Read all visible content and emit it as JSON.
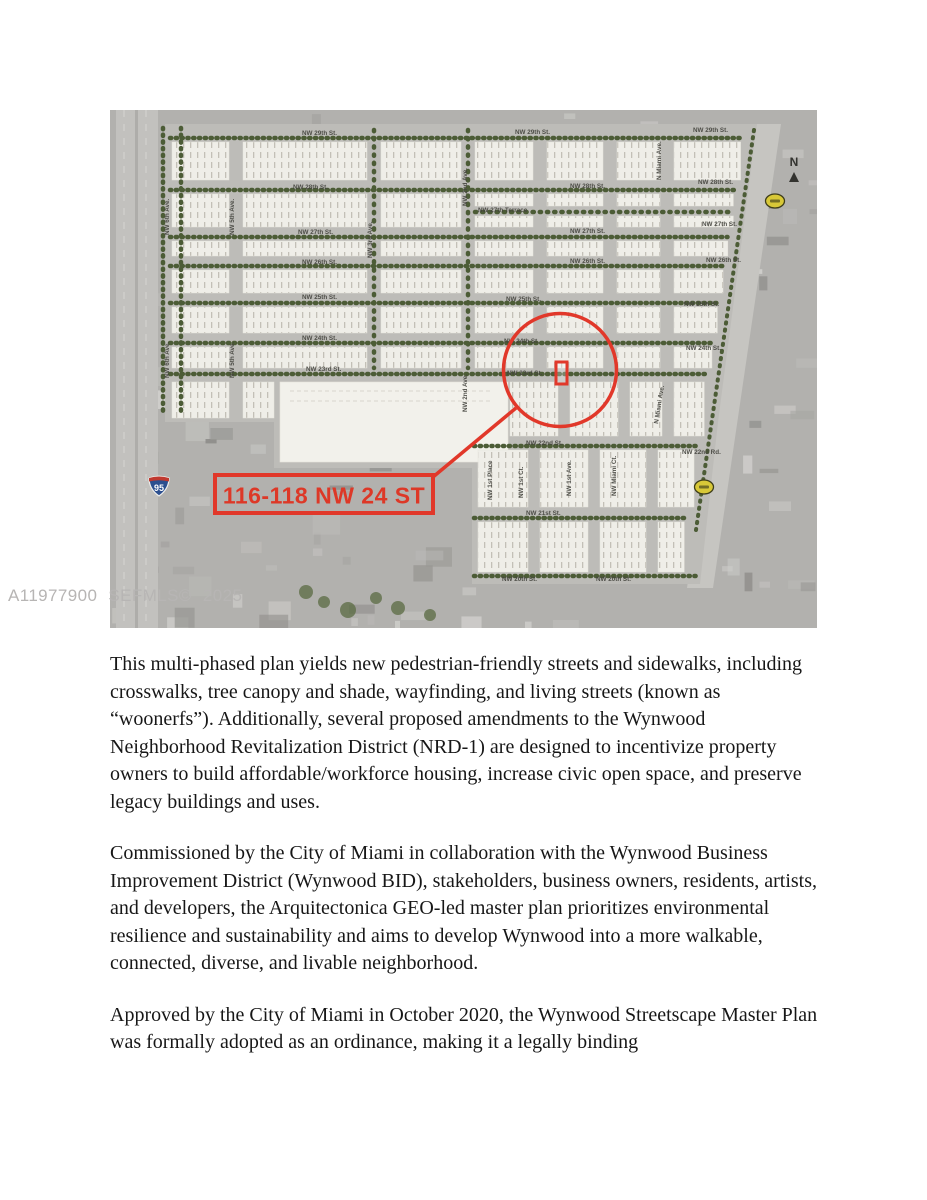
{
  "watermark": {
    "text": "A11977900 SEFMLS© 2025"
  },
  "map": {
    "marker_label": "116-118 NW 24 ST",
    "north_arrow_label": "N",
    "interstate_shield_number": "95",
    "accent_red": "#e1382a",
    "plan_fill": "#efeee8",
    "street_labels": [
      {
        "t": "NW 29th St.",
        "x": 192,
        "y": 25
      },
      {
        "t": "NW 29th St.",
        "x": 405,
        "y": 24
      },
      {
        "t": "NW 29th St.",
        "x": 583,
        "y": 22
      },
      {
        "t": "NW 28th St.",
        "x": 183,
        "y": 79
      },
      {
        "t": "NW 28th St.",
        "x": 460,
        "y": 78
      },
      {
        "t": "NW 28th St.",
        "x": 588,
        "y": 74
      },
      {
        "t": "NW 27th Terrace",
        "x": 368,
        "y": 102
      },
      {
        "t": "NW 27th St.",
        "x": 188,
        "y": 124
      },
      {
        "t": "NW 27th St.",
        "x": 460,
        "y": 123
      },
      {
        "t": "NW 27th St.",
        "x": 592,
        "y": 116
      },
      {
        "t": "NW 26th St.",
        "x": 192,
        "y": 154
      },
      {
        "t": "NW 26th St.",
        "x": 460,
        "y": 153
      },
      {
        "t": "NW 26th St.",
        "x": 596,
        "y": 152
      },
      {
        "t": "NW 25th St.",
        "x": 192,
        "y": 189
      },
      {
        "t": "NW 25th St.",
        "x": 396,
        "y": 191
      },
      {
        "t": "NW 25th St.",
        "x": 574,
        "y": 196
      },
      {
        "t": "NW 24th St.",
        "x": 192,
        "y": 230
      },
      {
        "t": "NW 24th St.",
        "x": 394,
        "y": 233
      },
      {
        "t": "NW 24th St.",
        "x": 576,
        "y": 240
      },
      {
        "t": "NW 23rd St.",
        "x": 196,
        "y": 261
      },
      {
        "t": "NW 23rd St.",
        "x": 397,
        "y": 265
      },
      {
        "t": "NW 22nd St.",
        "x": 416,
        "y": 335
      },
      {
        "t": "NW 22nd Rd.",
        "x": 572,
        "y": 344
      },
      {
        "t": "NW 21st St.",
        "x": 416,
        "y": 405
      },
      {
        "t": "NW 20th St.",
        "x": 392,
        "y": 471
      },
      {
        "t": "NW 20th St.",
        "x": 486,
        "y": 471
      }
    ],
    "avenue_labels": [
      {
        "t": "NW 6th Ave.",
        "x": 59,
        "y": 125,
        "r": -90
      },
      {
        "t": "NW 6th Ave.",
        "x": 59,
        "y": 268,
        "r": -90
      },
      {
        "t": "NW 5th Ave.",
        "x": 124,
        "y": 125,
        "r": -90
      },
      {
        "t": "NW 5th Ave.",
        "x": 124,
        "y": 268,
        "r": -90
      },
      {
        "t": "NW 3rd Ave.",
        "x": 262,
        "y": 148,
        "r": -90
      },
      {
        "t": "NW 2nd Ave.",
        "x": 357,
        "y": 96,
        "r": -90
      },
      {
        "t": "NW 2nd Ave.",
        "x": 357,
        "y": 302,
        "r": -90
      },
      {
        "t": "NW 1st Place",
        "x": 382,
        "y": 390,
        "r": -90
      },
      {
        "t": "NW 1st Ct.",
        "x": 413,
        "y": 388,
        "r": -90
      },
      {
        "t": "NW 1st Ave.",
        "x": 461,
        "y": 386,
        "r": -90
      },
      {
        "t": "NW Miami Ct.",
        "x": 506,
        "y": 386,
        "r": -90
      },
      {
        "t": "N Miami Ave.",
        "x": 551,
        "y": 70,
        "r": -90
      },
      {
        "t": "N Miami Ave.",
        "x": 548,
        "y": 314,
        "r": -81
      }
    ]
  },
  "article": {
    "paragraphs": [
      "This multi-phased plan yields new pedestrian-friendly streets and sidewalks, including crosswalks, tree canopy and shade, wayfinding, and living streets (known as “woonerfs”). Additionally, several proposed amendments to the Wynwood Neighborhood Revitalization District (NRD-1) are designed to incentivize property owners to build affordable/workforce housing, increase civic open space, and preserve legacy buildings and uses.",
      "Commissioned by the City of Miami in collaboration with the Wynwood Business Improvement District (Wynwood BID), stakeholders, business owners, residents, artists, and developers, the Arquitectonica GEO-led master plan prioritizes environmental resilience and sustainability and aims to develop Wynwood into a more walkable, connected, diverse, and livable neighborhood.",
      "Approved by the City of Miami in October 2020, the Wynwood Streetscape Master Plan was formally adopted as an ordinance, making it a legally binding"
    ]
  }
}
